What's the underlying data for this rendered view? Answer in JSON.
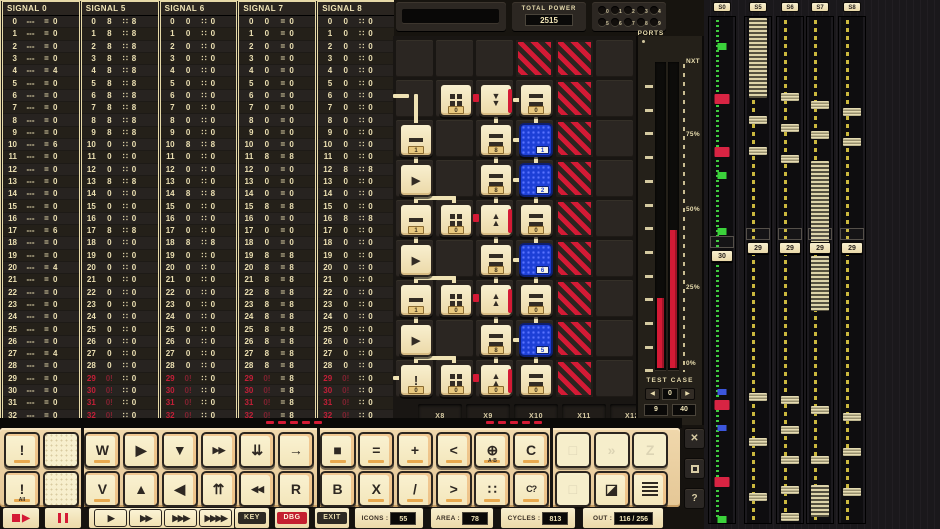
{
  "signal_table": {
    "columns": [
      {
        "name": "SIGNAL 0",
        "sep": "=",
        "dash": "---",
        "outputs": [
          "0",
          "0",
          "0",
          "0",
          "4",
          "0",
          "0",
          "0",
          "0",
          "0",
          "6",
          "0",
          "0",
          "0",
          "0",
          "0",
          "0",
          "6",
          "0",
          "0",
          "4",
          "0",
          "0",
          "0",
          "0",
          "0",
          "0",
          "4",
          "0",
          "0",
          "0",
          "0",
          "0"
        ]
      },
      {
        "name": "SIGNAL 5",
        "sep": "∷",
        "inputs": [
          "8",
          "8",
          "8",
          "8",
          "8",
          "8",
          "8",
          "8",
          "8",
          "8",
          "0",
          "0",
          "0",
          "8",
          "0",
          "0",
          "0",
          "8",
          "0",
          "0",
          "0",
          "0",
          "0",
          "0",
          "0",
          "0",
          "0",
          "0",
          "0",
          "0!",
          "0!",
          "0!",
          "0!"
        ],
        "outputs": [
          "8",
          "8",
          "8",
          "8",
          "8",
          "8",
          "8",
          "8",
          "8",
          "8",
          "0",
          "0",
          "0",
          "8",
          "0",
          "0",
          "0",
          "8",
          "0",
          "0",
          "0",
          "0",
          "0",
          "0",
          "0",
          "0",
          "0",
          "0",
          "0",
          "0",
          "0",
          "0",
          "0"
        ]
      },
      {
        "name": "SIGNAL 6",
        "sep": "∷",
        "inputs": [
          "0",
          "0",
          "0",
          "0",
          "0",
          "0",
          "0",
          "0",
          "0",
          "0",
          "8",
          "0",
          "0",
          "0",
          "8",
          "0",
          "0",
          "0",
          "8",
          "0",
          "0",
          "0",
          "0",
          "0",
          "0",
          "0",
          "0",
          "0",
          "0",
          "0!",
          "0!",
          "0!",
          "0!"
        ],
        "outputs": [
          "0",
          "0",
          "0",
          "0",
          "0",
          "0",
          "0",
          "0",
          "0",
          "0",
          "8",
          "0",
          "0",
          "0",
          "8",
          "0",
          "0",
          "0",
          "8",
          "0",
          "0",
          "0",
          "0",
          "0",
          "0",
          "0",
          "0",
          "0",
          "0",
          "0",
          "0",
          "0",
          "0"
        ]
      },
      {
        "name": "SIGNAL 7",
        "sep": "=",
        "inputs": [
          "0",
          "0",
          "0",
          "0",
          "0",
          "0",
          "0",
          "0",
          "0",
          "0",
          "0",
          "8",
          "0",
          "0",
          "0",
          "8",
          "0",
          "0",
          "0",
          "8",
          "8",
          "8",
          "8",
          "8",
          "8",
          "8",
          "8",
          "8",
          "8",
          "0!",
          "0!",
          "0!",
          "0!"
        ],
        "outputs": [
          "0",
          "0",
          "0",
          "0",
          "0",
          "0",
          "0",
          "0",
          "0",
          "0",
          "0",
          "8",
          "0",
          "0",
          "0",
          "8",
          "0",
          "0",
          "0",
          "8",
          "8",
          "8",
          "8",
          "8",
          "8",
          "8",
          "8",
          "8",
          "8",
          "8",
          "8",
          "8",
          "8"
        ]
      },
      {
        "name": "SIGNAL 8",
        "sep": "∷",
        "inputs": [
          "0",
          "0",
          "0",
          "0",
          "0",
          "0",
          "0",
          "0",
          "0",
          "0",
          "0",
          "0",
          "8",
          "0",
          "0",
          "0",
          "8",
          "0",
          "0",
          "0",
          "0",
          "0",
          "0",
          "0",
          "0",
          "0",
          "0",
          "0",
          "0",
          "0!",
          "0!",
          "0!",
          "0!"
        ],
        "outputs": [
          "0",
          "0",
          "0",
          "0",
          "0",
          "0",
          "0",
          "0",
          "0",
          "0",
          "0",
          "0",
          "8",
          "0",
          "0",
          "0",
          "8",
          "0",
          "0",
          "0",
          "0",
          "0",
          "0",
          "0",
          "0",
          "0",
          "0",
          "0",
          "0",
          "0",
          "0",
          "0",
          "0"
        ]
      }
    ]
  },
  "top_bar": {
    "total_power_label": "TOTAL POWER",
    "total_power_value": "2515",
    "ports_label": "PORTS",
    "port_digits": [
      "0",
      "1",
      "2",
      "3",
      "4",
      "5",
      "6",
      "7",
      "8",
      "9"
    ]
  },
  "grid": {
    "footer_labels": [
      "X8",
      "X9",
      "X10",
      "X11",
      "X12"
    ],
    "glyphs": {
      "chev_down": "▼",
      "chev_up": "▲",
      "arrow_right": "▶",
      "excl": "!"
    },
    "tiles": [
      {
        "r": 1,
        "c": 1,
        "k": "grid4",
        "lab": "0"
      },
      {
        "r": 1,
        "c": 2,
        "k": "chevdown",
        "lab": "",
        "stripe": 1
      },
      {
        "r": 1,
        "c": 3,
        "k": "equals",
        "lab": "0"
      },
      {
        "r": 2,
        "c": 0,
        "k": "minus",
        "lab": "1"
      },
      {
        "r": 2,
        "c": 2,
        "k": "equals",
        "lab": "8"
      },
      {
        "r": 2,
        "c": 3,
        "k": "blue",
        "lab": "1"
      },
      {
        "r": 3,
        "c": 0,
        "k": "arrow",
        "lab": ""
      },
      {
        "r": 3,
        "c": 2,
        "k": "equals",
        "lab": "8"
      },
      {
        "r": 3,
        "c": 3,
        "k": "blue",
        "lab": "2"
      },
      {
        "r": 4,
        "c": 0,
        "k": "minus",
        "lab": "1"
      },
      {
        "r": 4,
        "c": 1,
        "k": "grid4",
        "lab": "0"
      },
      {
        "r": 4,
        "c": 2,
        "k": "chevup",
        "lab": "",
        "stripe": 1
      },
      {
        "r": 4,
        "c": 3,
        "k": "equals",
        "lab": "0"
      },
      {
        "r": 5,
        "c": 0,
        "k": "arrow",
        "lab": ""
      },
      {
        "r": 5,
        "c": 2,
        "k": "equals",
        "lab": "8"
      },
      {
        "r": 5,
        "c": 3,
        "k": "blue",
        "lab": "6"
      },
      {
        "r": 6,
        "c": 0,
        "k": "minus",
        "lab": "1"
      },
      {
        "r": 6,
        "c": 1,
        "k": "grid4",
        "lab": "0"
      },
      {
        "r": 6,
        "c": 2,
        "k": "chevup",
        "lab": "",
        "stripe": 1
      },
      {
        "r": 6,
        "c": 3,
        "k": "equals",
        "lab": "0"
      },
      {
        "r": 7,
        "c": 0,
        "k": "arrow",
        "lab": ""
      },
      {
        "r": 7,
        "c": 2,
        "k": "equals",
        "lab": "8"
      },
      {
        "r": 7,
        "c": 3,
        "k": "blue",
        "lab": "5"
      },
      {
        "r": 8,
        "c": 0,
        "k": "excl",
        "lab": "0"
      },
      {
        "r": 8,
        "c": 1,
        "k": "grid4",
        "lab": "0"
      },
      {
        "r": 8,
        "c": 2,
        "k": "chevup",
        "lab": "0",
        "stripe": 1
      },
      {
        "r": 8,
        "c": 3,
        "k": "equals",
        "lab": "0"
      }
    ],
    "hatches": [
      [
        0,
        3
      ],
      [
        0,
        4
      ],
      [
        1,
        4
      ],
      [
        2,
        4
      ],
      [
        3,
        4
      ],
      [
        4,
        4
      ],
      [
        5,
        4
      ],
      [
        6,
        4
      ],
      [
        7,
        4
      ],
      [
        8,
        4
      ]
    ],
    "wires": [
      [
        0,
        58,
        16,
        4,
        0
      ],
      [
        21,
        58,
        4,
        290,
        0
      ],
      [
        23,
        160,
        40,
        4,
        0
      ],
      [
        59,
        160,
        4,
        12,
        0
      ],
      [
        23,
        240,
        40,
        4,
        0
      ],
      [
        59,
        240,
        4,
        12,
        0
      ],
      [
        23,
        320,
        40,
        4,
        0
      ],
      [
        59,
        320,
        4,
        12,
        0
      ],
      [
        101,
        81,
        4,
        8,
        0
      ],
      [
        101,
        121,
        4,
        8,
        0
      ],
      [
        101,
        161,
        4,
        8,
        0
      ],
      [
        101,
        201,
        4,
        8,
        0
      ],
      [
        101,
        241,
        4,
        8,
        0
      ],
      [
        101,
        281,
        4,
        8,
        0
      ],
      [
        101,
        321,
        4,
        8,
        0
      ],
      [
        141,
        81,
        4,
        8,
        0
      ],
      [
        141,
        121,
        4,
        8,
        0
      ],
      [
        141,
        161,
        4,
        8,
        0
      ],
      [
        141,
        201,
        4,
        8,
        0
      ],
      [
        141,
        241,
        4,
        8,
        0
      ],
      [
        141,
        281,
        4,
        8,
        0
      ],
      [
        141,
        321,
        4,
        8,
        0
      ],
      [
        120,
        62,
        8,
        4,
        0
      ],
      [
        120,
        102,
        8,
        4,
        0
      ],
      [
        120,
        142,
        8,
        4,
        0
      ],
      [
        120,
        222,
        8,
        4,
        0
      ],
      [
        120,
        302,
        8,
        4,
        0
      ],
      [
        0,
        340,
        10,
        4,
        0
      ],
      [
        80,
        58,
        6,
        8,
        1
      ],
      [
        80,
        178,
        6,
        8,
        1
      ],
      [
        80,
        258,
        6,
        8,
        1
      ],
      [
        80,
        338,
        6,
        8,
        1
      ]
    ]
  },
  "gauge": {
    "labels": [
      {
        "text": "NXT",
        "y": 22
      },
      {
        "text": "75%",
        "y": 95
      },
      {
        "text": "50%",
        "y": 170
      },
      {
        "text": "25%",
        "y": 248
      },
      {
        "text": "0%",
        "y": 324
      }
    ],
    "bars": [
      {
        "x": 19,
        "y": 262,
        "h": 70
      },
      {
        "x": 32,
        "y": 194,
        "h": 138
      }
    ],
    "test_case": {
      "label": "TEST CASE",
      "prev": "◀",
      "next": "▶",
      "index": "0",
      "value_a": "9",
      "value_b": "40"
    }
  },
  "sliders": {
    "tracks": [
      {
        "id": "S0",
        "value": "30",
        "line": "green",
        "x": 4,
        "vy": 234,
        "marks": [
          [
            27,
            "g"
          ],
          [
            78,
            "r"
          ],
          [
            131,
            "r"
          ],
          [
            156,
            "g"
          ],
          [
            212,
            "g"
          ],
          [
            373,
            "b"
          ],
          [
            384,
            "r"
          ],
          [
            409,
            "b"
          ],
          [
            461,
            "r"
          ],
          [
            500,
            "g"
          ]
        ]
      },
      {
        "id": "S5",
        "value": "29",
        "line": "yellow",
        "x": 40,
        "vy": 226,
        "marks": [
          [
            2,
            "s",
            80
          ],
          [
            100,
            "k"
          ],
          [
            131,
            "k"
          ],
          [
            377,
            "k"
          ],
          [
            422,
            "k"
          ],
          [
            477,
            "k"
          ]
        ]
      },
      {
        "id": "S6",
        "value": "29",
        "line": "yellow",
        "x": 72,
        "vy": 226,
        "marks": [
          [
            77,
            "k"
          ],
          [
            108,
            "k"
          ],
          [
            139,
            "k"
          ],
          [
            380,
            "k"
          ],
          [
            410,
            "k"
          ],
          [
            440,
            "k"
          ],
          [
            470,
            "k"
          ],
          [
            497,
            "k"
          ]
        ]
      },
      {
        "id": "S7",
        "value": "29",
        "line": "yellow",
        "x": 102,
        "vy": 226,
        "marks": [
          [
            85,
            "k"
          ],
          [
            115,
            "k"
          ],
          [
            145,
            "s",
            82
          ],
          [
            240,
            "s",
            55
          ],
          [
            390,
            "k"
          ],
          [
            440,
            "k"
          ],
          [
            469,
            "s",
            32
          ]
        ]
      },
      {
        "id": "S8",
        "value": "29",
        "line": "yellow",
        "x": 134,
        "vy": 226,
        "marks": [
          [
            92,
            "k"
          ],
          [
            122,
            "k"
          ],
          [
            397,
            "k"
          ],
          [
            432,
            "k"
          ],
          [
            472,
            "k"
          ]
        ]
      }
    ]
  },
  "keyboard": {
    "led_groups": [
      266,
      486
    ],
    "rows": [
      [
        {
          "g": "!",
          "n": "key-exclaim",
          "u": 1
        },
        {
          "g": "",
          "n": "key-blank-1",
          "blank": 1
        },
        {
          "g": "W",
          "n": "key-w",
          "u": 1
        },
        {
          "g": "▶",
          "n": "key-play"
        },
        {
          "g": "▼",
          "n": "key-down"
        },
        {
          "g": "▶▶",
          "n": "key-fast-forward",
          "sm": 1
        },
        {
          "g": "⇊",
          "n": "key-double-down"
        },
        {
          "g": "→",
          "n": "key-right"
        },
        {
          "g": "■",
          "n": "key-stop",
          "u": 1
        },
        {
          "g": "=",
          "n": "key-equals",
          "u": 1
        },
        {
          "g": "+",
          "n": "key-plus",
          "u": 1
        },
        {
          "g": "<",
          "n": "key-less-than",
          "u": 1
        },
        {
          "g": "⊕",
          "n": "key-combine",
          "sub": "A·B",
          "u": 1
        },
        {
          "g": "C",
          "n": "key-c",
          "u": 1
        },
        {
          "g": "□",
          "n": "key-frame",
          "f": 1
        },
        {
          "g": "»",
          "n": "key-skip",
          "f": 1
        },
        {
          "g": "Z",
          "n": "key-z",
          "f": 1
        }
      ],
      [
        {
          "g": "!",
          "n": "key-exclaim-all",
          "sub": "All",
          "u": 1
        },
        {
          "g": "",
          "n": "key-blank-2",
          "blank": 1
        },
        {
          "g": "V",
          "n": "key-v",
          "u": 1
        },
        {
          "g": "▲",
          "n": "key-up"
        },
        {
          "g": "◀",
          "n": "key-left"
        },
        {
          "g": "⇈",
          "n": "key-double-up"
        },
        {
          "g": "◀◀",
          "n": "key-rewind",
          "sm": 1
        },
        {
          "g": "R",
          "n": "key-r"
        },
        {
          "g": "B",
          "n": "key-b"
        },
        {
          "g": "X",
          "n": "key-x",
          "u": 1
        },
        {
          "g": "/",
          "n": "key-slash",
          "u": 1
        },
        {
          "g": ">",
          "n": "key-greater-than",
          "u": 1
        },
        {
          "g": "∷",
          "n": "key-dots",
          "u": 1
        },
        {
          "g": "C?",
          "n": "key-c-question",
          "u": 1,
          "sm": 1
        },
        {
          "g": "□",
          "n": "key-frame-2",
          "f": 1
        },
        {
          "g": "◪",
          "n": "key-contrast"
        },
        {
          "g": "",
          "n": "key-doc",
          "ic": "doc"
        }
      ]
    ]
  },
  "status_bar": {
    "transport": [
      {
        "n": "stop-play-button",
        "kind": "recplay"
      },
      {
        "n": "pause-button",
        "kind": "pause"
      }
    ],
    "speeds": [
      "▶",
      "▶▶",
      "▶▶▶",
      "▶▶▶▶"
    ],
    "badges": [
      {
        "text": "KEY",
        "style": "dark",
        "n": "key-mode-badge"
      },
      {
        "text": "DBG",
        "style": "red",
        "n": "debug-badge"
      },
      {
        "text": "EXIT",
        "style": "dark",
        "n": "exit-badge"
      }
    ],
    "counters": [
      {
        "label": "ICONS :",
        "value": "55"
      },
      {
        "label": "AREA :",
        "value": "78"
      },
      {
        "label": "CYCLES :",
        "value": "813"
      },
      {
        "label": "OUT :",
        "value": "116 / 256"
      }
    ]
  },
  "side_buttons": [
    {
      "n": "close-button",
      "g": "✕"
    },
    {
      "n": "frame-button",
      "g": "",
      "sq": 1
    },
    {
      "n": "help-button",
      "g": "?"
    }
  ]
}
